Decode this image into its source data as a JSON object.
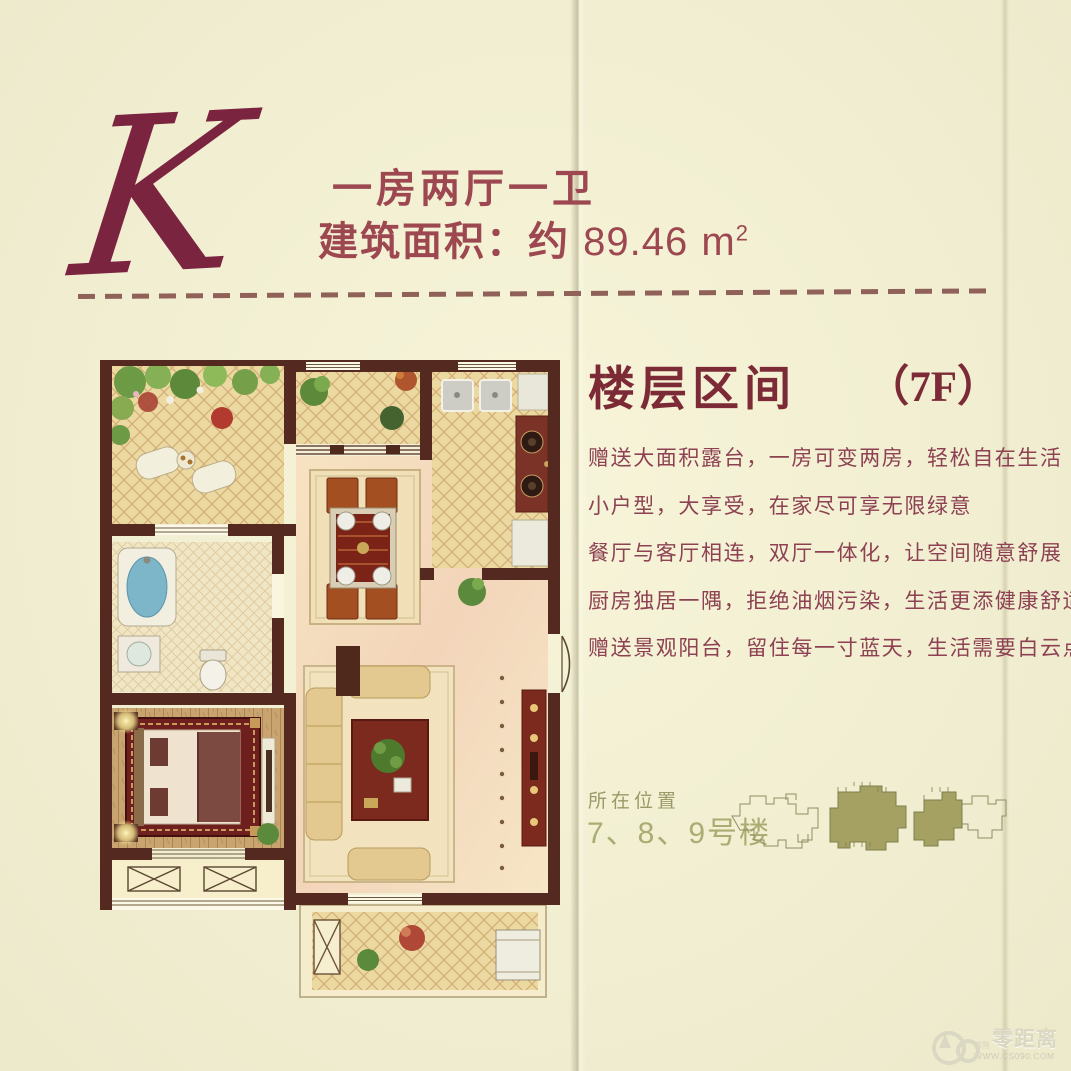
{
  "header": {
    "unit_letter": "K",
    "layout": "一房两厅一卫",
    "area_label": "建筑面积：约",
    "area_value": "89.46",
    "area_unit_base": "m",
    "area_unit_exp": "2"
  },
  "floor_info": {
    "heading": "楼层区间",
    "floor_badge": "（7F）",
    "features": [
      "赠送大面积露台，一房可变两房，轻松自在生活",
      "小户型，大享受，在家尽可享无限绿意",
      "餐厅与客厅相连，双厅一体化，让空间随意舒展",
      "厨房独居一隅，拒绝油烟污染，生活更添健康舒适",
      "赠送景观阳台，留住每一寸蓝天，生活需要白云点缀"
    ]
  },
  "location": {
    "label": "所在位置",
    "buildings": "7、8、9号楼"
  },
  "watermark": {
    "brand_small": "常熟",
    "brand": "零距离",
    "url": "WWW.CS090.COM"
  },
  "colors": {
    "background": "#f6f3d6",
    "maroon_text": "#8d4152",
    "heading_maroon": "#7c2a36",
    "letter_maroon": "#7b2440",
    "wall_brown": "#542a20",
    "olive": "#abab72",
    "site_fill": "#a5a163"
  }
}
